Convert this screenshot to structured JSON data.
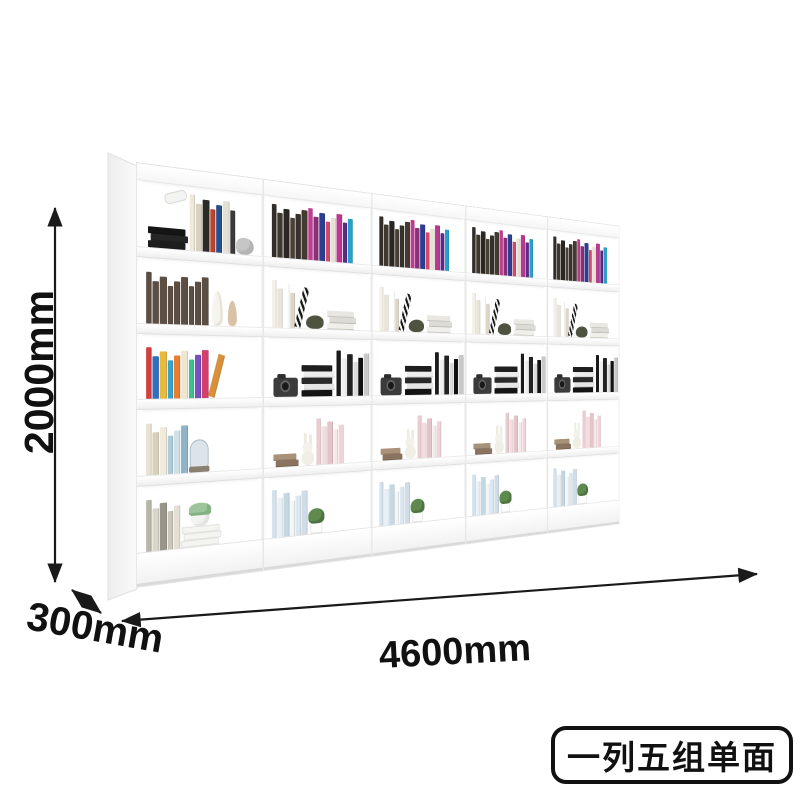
{
  "image": {
    "background": "#ffffff"
  },
  "annotations": {
    "height_label": "2000mm",
    "depth_label": "300mm",
    "width_label": "4600mm",
    "arrow_color": "#1a1a1a",
    "text_color": "#111111"
  },
  "badge": {
    "text": "一列五组单面",
    "border_color": "#111111",
    "text_color": "#111111",
    "background": "#ffffff"
  },
  "shelf": {
    "units_count": 5,
    "rows_per_unit": 5,
    "frame_color": "#ffffff",
    "first_unit_rows": [
      [
        {
          "t": "stack",
          "c": [
            "#151515",
            "#262626",
            "#1d1d1d"
          ],
          "w": 42
        },
        {
          "t": "item",
          "n": "mic"
        },
        {
          "t": "books",
          "c": [
            "#efe9dc",
            "#d9d2c0",
            "#2e2a26",
            "#b8452e",
            "#274e8d",
            "#e5e0d4",
            "#3b3b3d"
          ]
        },
        {
          "t": "item",
          "n": "rock"
        }
      ],
      [
        {
          "t": "books",
          "c": [
            "#5d4e44",
            "#5d4e44",
            "#5d4e44",
            "#5d4e44",
            "#5d4e44",
            "#5d4e44",
            "#5d4e44",
            "#5d4e44",
            "#5d4e44"
          ]
        },
        {
          "t": "item",
          "n": "deer"
        }
      ],
      [
        {
          "t": "books",
          "c": [
            "#d23f3f",
            "#2f6fc0",
            "#e7b93c",
            "#39a3cf",
            "#e87f2f",
            "#efe6d2",
            "#3fbf8f",
            "#7a4fbf",
            "#d23f6f"
          ]
        },
        {
          "t": "lean",
          "c": "#d8913a"
        }
      ],
      [
        {
          "t": "books",
          "c": [
            "#e9e1d1",
            "#d9cfba",
            "#f1ebdc",
            "#aecbd9",
            "#cfe0e9",
            "#8fb4c9"
          ]
        },
        {
          "t": "item",
          "n": "dome"
        }
      ],
      [
        {
          "t": "books",
          "c": [
            "#b9b5a9",
            "#d9d5c9",
            "#99958a",
            "#c9c5b9",
            "#e3dfd3"
          ]
        },
        {
          "t": "item",
          "n": "potstack"
        }
      ]
    ],
    "repeat_unit_rows": [
      [
        {
          "t": "books",
          "c": [
            "#332e29",
            "#3f382f",
            "#2b2722",
            "#4a4136",
            "#36312a",
            "#433b31"
          ]
        },
        {
          "t": "books",
          "c": [
            "#c23a92",
            "#8a2f7a",
            "#2c3e8f",
            "#d14a6a",
            "#e8e2d6",
            "#b83a8e",
            "#5a2a8a",
            "#28a0c8"
          ]
        }
      ],
      [
        {
          "t": "books",
          "c": [
            "#f4f1e9",
            "#eae5d9",
            "#ffffff",
            "#ded7c8"
          ]
        },
        {
          "t": "lean",
          "c": "stripes"
        },
        {
          "t": "item",
          "n": "moss"
        },
        {
          "t": "stack",
          "c": [
            "#e9e7e1",
            "#dddbd5",
            "#f1efe9"
          ],
          "w": 38
        }
      ],
      [
        {
          "t": "item",
          "n": "camera"
        },
        {
          "t": "stack",
          "c": [
            "#1e1e1e",
            "#ededed",
            "#2a2a2a",
            "#e5e5e5",
            "#141414"
          ],
          "w": 42
        },
        {
          "t": "books",
          "c": [
            "#1a1a1a",
            "#f0f0f0",
            "#222222",
            "#dddddd",
            "#111111",
            "#c9c9c9"
          ]
        }
      ],
      [
        {
          "t": "stack",
          "c": [
            "#a8927a",
            "#8a7460"
          ],
          "w": 30
        },
        {
          "t": "item",
          "n": "rabbit"
        },
        {
          "t": "books",
          "c": [
            "#e9cdd1",
            "#f3dde0",
            "#e2c4c9",
            "#f7e8ea",
            "#eed4d8"
          ]
        }
      ],
      [
        {
          "t": "books",
          "c": [
            "#d3e2ec",
            "#e8f0f5",
            "#c4d8e4",
            "#f2f6f8",
            "#dce8f0",
            "#cfdde8"
          ]
        },
        {
          "t": "item",
          "n": "plant"
        }
      ]
    ]
  }
}
